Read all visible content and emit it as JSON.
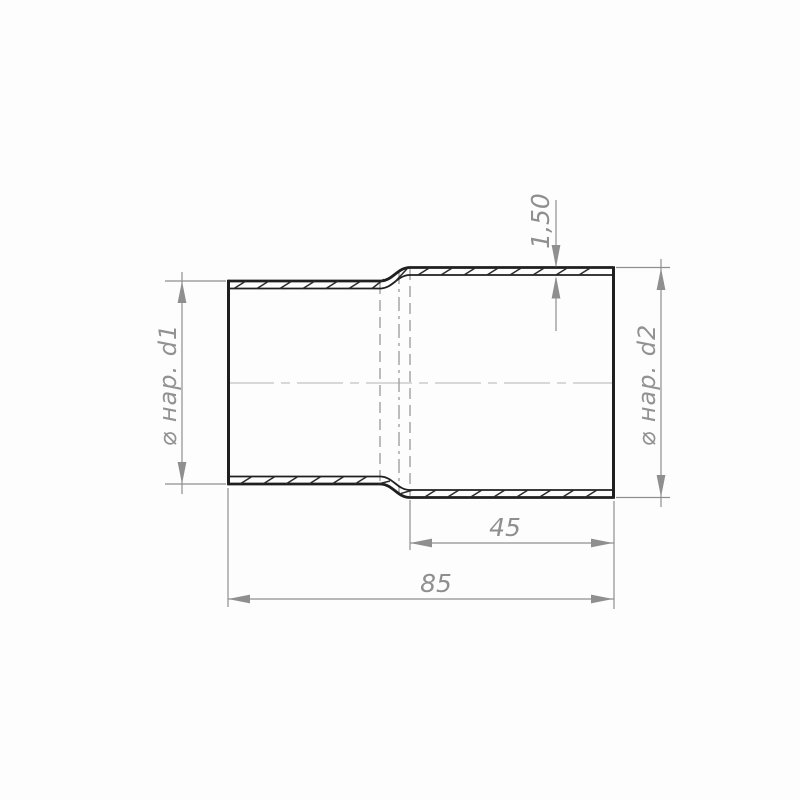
{
  "drawing": {
    "title": "pipe-reducer-adapter-cross-section",
    "labels": {
      "left_diameter": "⌀ нар. d1",
      "right_diameter": "⌀ нар. d2",
      "wall_thickness": "1,50",
      "right_section_length": "45",
      "total_length": "85"
    },
    "values": {
      "wall_thickness_mm": 1.5,
      "right_section_length_mm": 45,
      "total_length_mm": 85
    },
    "colors": {
      "outline": "#1f1f1f",
      "hatch": "#2a2a2a",
      "dimension": "#8f8f8f",
      "hidden_line": "#9a9a9a",
      "centerline": "#c2c2c2",
      "background": "#fdfdfd"
    }
  }
}
